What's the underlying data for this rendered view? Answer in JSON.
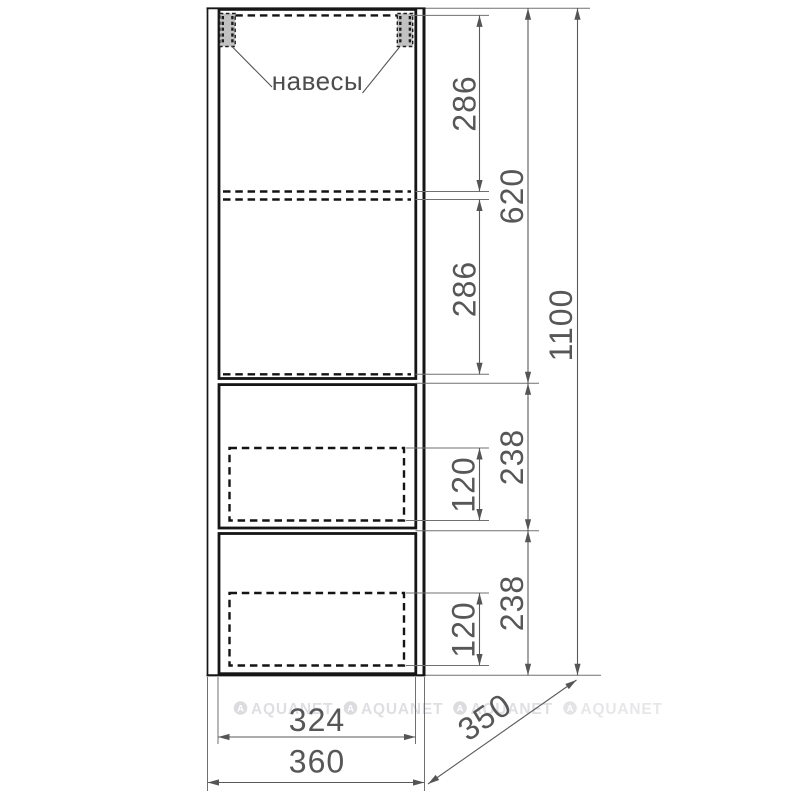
{
  "drawing": {
    "type": "furniture-dimension-drawing",
    "annotation_label": "навесы",
    "dimensions": {
      "shelf_top": "286",
      "shelf_bottom": "286",
      "upper_section": "620",
      "total_height": "1100",
      "drawer1_front": "238",
      "drawer1_box": "120",
      "drawer2_front": "238",
      "drawer2_box": "120",
      "front_width": "324",
      "total_width": "360",
      "depth": "350"
    },
    "watermark": "AQUANET",
    "watermark_logo_letter": "A",
    "colors": {
      "cabinet_line": "#161616",
      "dimension_line": "#5a5a5a",
      "flute_stripe": "#a6a6a6",
      "hanger_fill": "#c1c1c1",
      "watermark": "#dfdfe3"
    }
  }
}
